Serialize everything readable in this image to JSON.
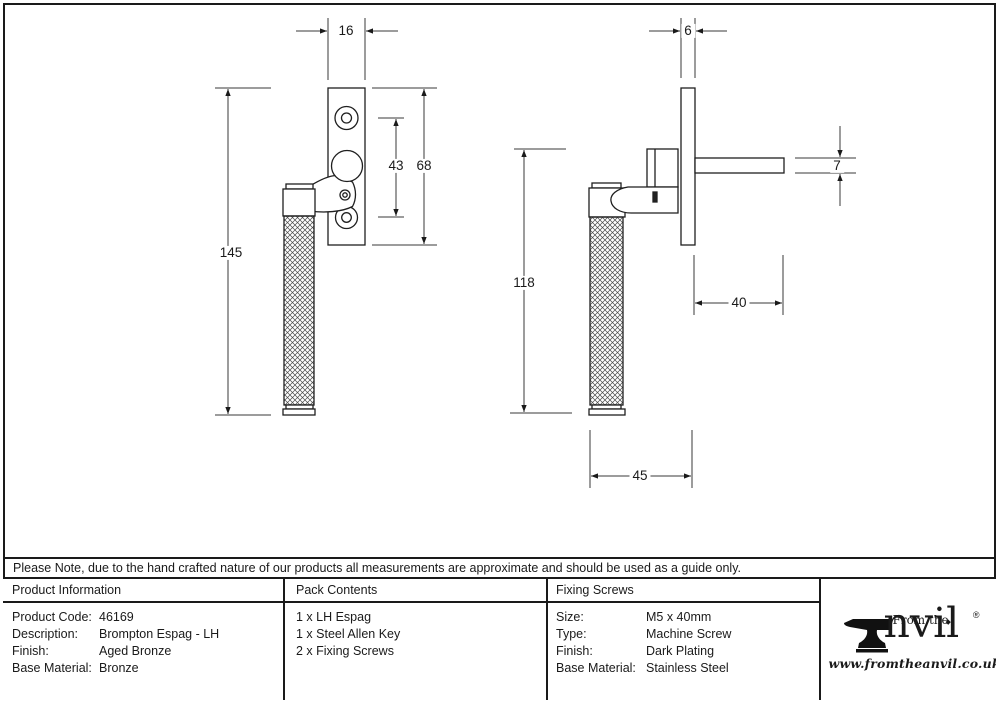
{
  "note": {
    "text": "Please Note, due to the hand crafted nature of our products all measurements are approximate and should be used as a guide only."
  },
  "drawing": {
    "front_view": {
      "plate_width": "16",
      "hole_spacing": "43",
      "plate_height": "68",
      "overall_length": "145"
    },
    "side_view": {
      "plate_thickness": "6",
      "spindle_height": "7",
      "handle_length": "118",
      "spindle_length": "40",
      "projection": "45"
    }
  },
  "table": {
    "product_information": {
      "header": "Product Information",
      "rows": [
        {
          "label": "Product Code:",
          "value": "46169"
        },
        {
          "label": "Description:",
          "value": "Brompton Espag - LH"
        },
        {
          "label": "Finish:",
          "value": "Aged Bronze"
        },
        {
          "label": "Base Material:",
          "value": "Bronze"
        }
      ]
    },
    "pack_contents": {
      "header": "Pack Contents",
      "items": [
        "1 x LH Espag",
        "1 x Steel Allen Key",
        "2 x Fixing Screws"
      ]
    },
    "fixing_screws": {
      "header": "Fixing Screws",
      "rows": [
        {
          "label": "Size:",
          "value": "M5 x 40mm"
        },
        {
          "label": "Type:",
          "value": "Machine Screw"
        },
        {
          "label": "Finish:",
          "value": "Dark Plating"
        },
        {
          "label": "Base Material:",
          "value": "Stainless Steel"
        }
      ]
    }
  },
  "logo": {
    "prefix": "From the",
    "name": "nvil",
    "registered": "®",
    "diamond": "◆",
    "url": "www.fromtheanvil.co.uk"
  },
  "colors": {
    "line": "#1a1a1a",
    "background": "#ffffff"
  }
}
